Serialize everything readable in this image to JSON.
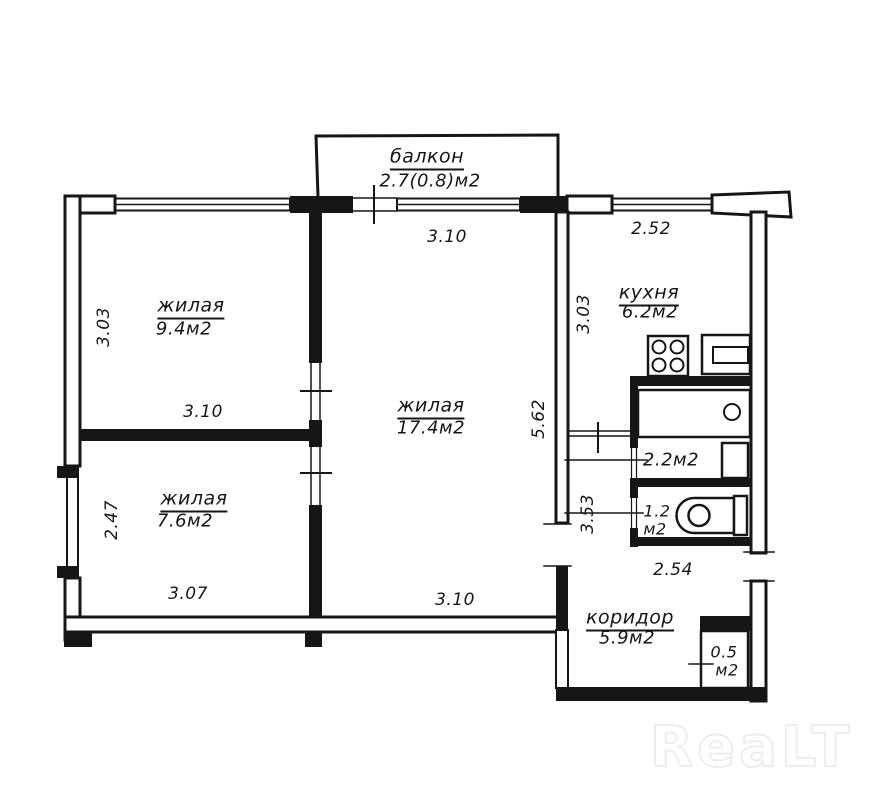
{
  "plan": {
    "balcony": {
      "name": "балкон",
      "area": "2.7(0.8)м2"
    },
    "rooms": {
      "living_top_left": {
        "name": "жилая",
        "area": "9.4м2"
      },
      "living_bottom_left": {
        "name": "жилая",
        "area": "7.6м2"
      },
      "living_center": {
        "name": "жилая",
        "area": "17.4м2"
      },
      "kitchen": {
        "name": "кухня",
        "area": "6.2м2"
      },
      "corridor": {
        "name": "коридор",
        "area": "5.9м2"
      },
      "bathroom": {
        "area": "2.2м2"
      },
      "toilet": {
        "area_line1": "1.2",
        "area_line2": "м2"
      },
      "closet": {
        "area_line1": "0.5",
        "area_line2": "м2"
      }
    },
    "dimensions": {
      "center_top_width": "3.10",
      "kitchen_top_width": "2.52",
      "top_left_height": "3.03",
      "top_left_width": "3.10",
      "bottom_left_height": "2.47",
      "bottom_left_width": "3.07",
      "center_height": "5.62",
      "center_bottom_width": "3.10",
      "kitchen_height": "3.03",
      "hallway_height": "3.53",
      "corridor_width": "2.54"
    }
  },
  "watermark": {
    "text": "ReaLT"
  },
  "colors": {
    "ink": "#161616",
    "background": "#ffffff",
    "watermark": "#ececec"
  }
}
